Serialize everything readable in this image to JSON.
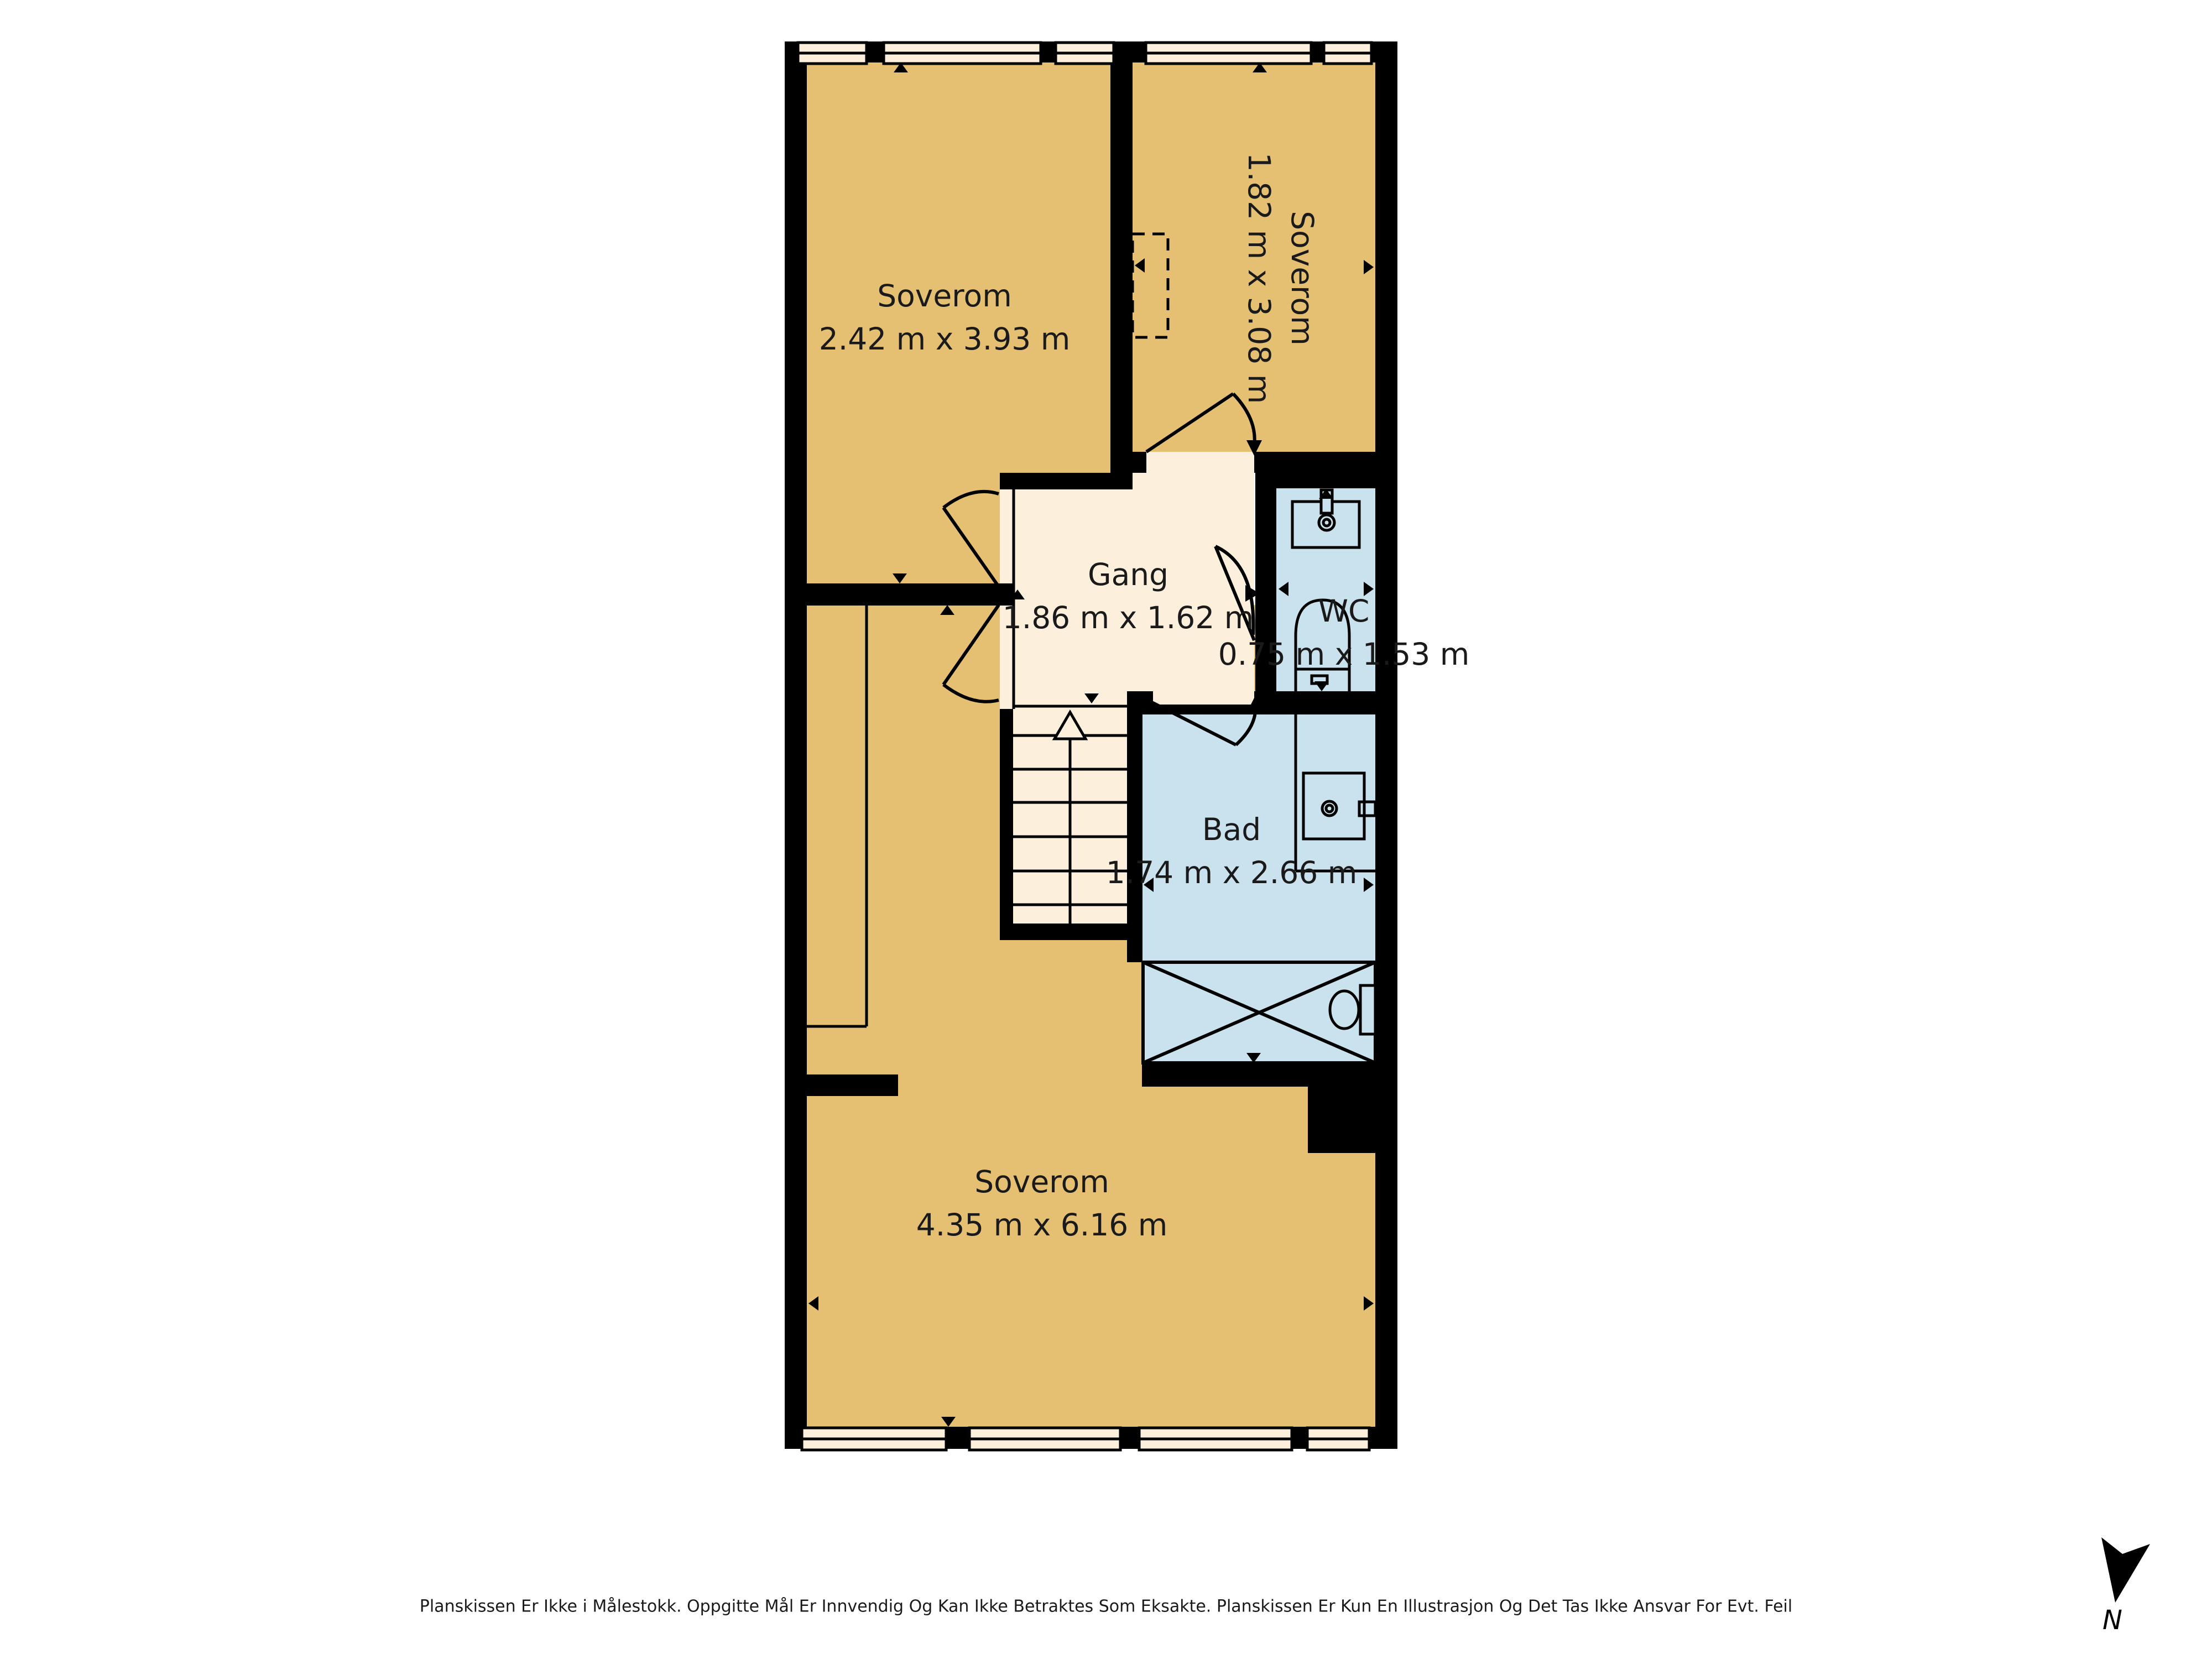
{
  "colors": {
    "room_tan": "#E5C073",
    "hall_cream": "#FCF0DC",
    "wet_blue": "#C9E2ED",
    "wall": "#000000",
    "text": "#1A1A1A"
  },
  "rooms": {
    "bedroom_top_left": {
      "name": "Soverom",
      "dimensions": "2.42 m x 3.93 m"
    },
    "bedroom_top_right": {
      "name": "Soverom",
      "dimensions": "1.82 m x 3.08 m"
    },
    "hallway": {
      "name": "Gang",
      "dimensions": "1.86 m x 1.62 m"
    },
    "wc": {
      "name": "WC",
      "dimensions": "0.75 m x 1.53 m"
    },
    "bathroom": {
      "name": "Bad",
      "dimensions": "1.74 m x 2.66 m"
    },
    "bedroom_bottom": {
      "name": "Soverom",
      "dimensions": "4.35 m x 6.16 m"
    }
  },
  "footer": {
    "disclaimer": "Planskissen Er Ikke i Målestokk. Oppgitte Mål Er Innvendig Og Kan Ikke Betraktes Som Eksakte. Planskissen Er Kun En Illustrasjon Og Det Tas Ikke Ansvar For Evt. Feil"
  },
  "compass": {
    "label": "N"
  }
}
